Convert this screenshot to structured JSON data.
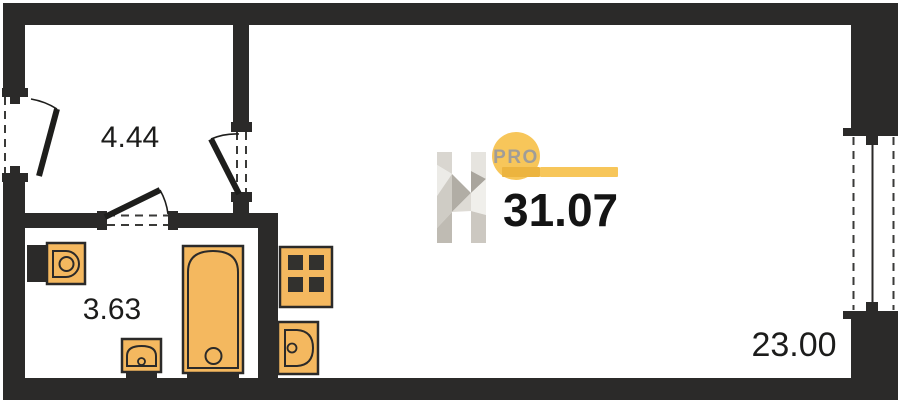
{
  "plan": {
    "type": "apartment-floor-plan",
    "rooms": [
      {
        "id": "hallway",
        "area": "4.44"
      },
      {
        "id": "bathroom",
        "area": "3.63"
      },
      {
        "id": "living-room",
        "area": "23.00"
      }
    ],
    "fixtures": [
      "toilet",
      "bathroom-sink",
      "bathtub",
      "stove",
      "kitchen-sink"
    ],
    "openings": [
      "entrance-door",
      "bathroom-door",
      "living-room-door",
      "window"
    ]
  },
  "logo": {
    "letter": "H",
    "badge": "PRO",
    "total_area": "31.07"
  },
  "colors": {
    "wall": "#2b2a29",
    "fixture_fill": "#f4b85f",
    "fixture_outline": "#2b2a29",
    "burner": "#32312e",
    "accent_yellow": "#f7c65a",
    "accent_yellow_dark": "#ecb43f",
    "badge_text": "#a09d98",
    "label_text": "#1c1c1b",
    "background": "#ffffff"
  }
}
